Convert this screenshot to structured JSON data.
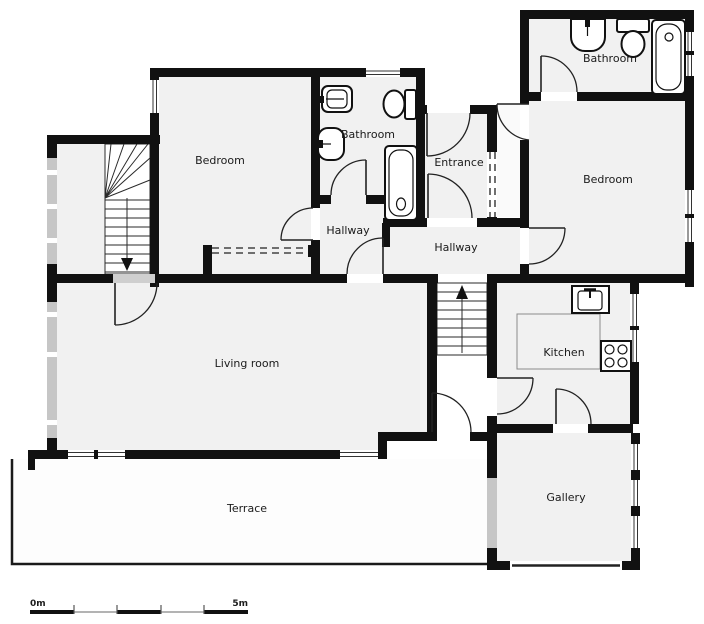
{
  "colors": {
    "wall": "#111111",
    "room_fill": "#f1f1f1",
    "stair_fill": "#ffffff",
    "terrace_fill": "#fdfdfd",
    "window_gray": "#c6c6c6",
    "door_stroke": "#222222",
    "label_color": "#1b1b1b",
    "background": "#ffffff"
  },
  "labels": {
    "bedroom_top_left": "Bedroom",
    "bathroom_middle": "Bathroom",
    "entrance": "Entrance",
    "bathroom_top_right": "Bathroom",
    "bedroom_right": "Bedroom",
    "hallway_small": "Hallway",
    "hallway_center": "Hallway",
    "living_room": "Living room",
    "kitchen": "Kitchen",
    "terrace": "Terrace",
    "gallery": "Gallery"
  },
  "scale_bar": {
    "start": "0m",
    "end": "5m"
  },
  "fixtures": [
    "sink-icon",
    "toilet-icon",
    "bathtub-icon",
    "kitchen-sink-icon",
    "stove-icon",
    "staircase-down-icon",
    "staircase-up-icon",
    "wardrobe-dashed-front",
    "sliding-door-dashed"
  ]
}
